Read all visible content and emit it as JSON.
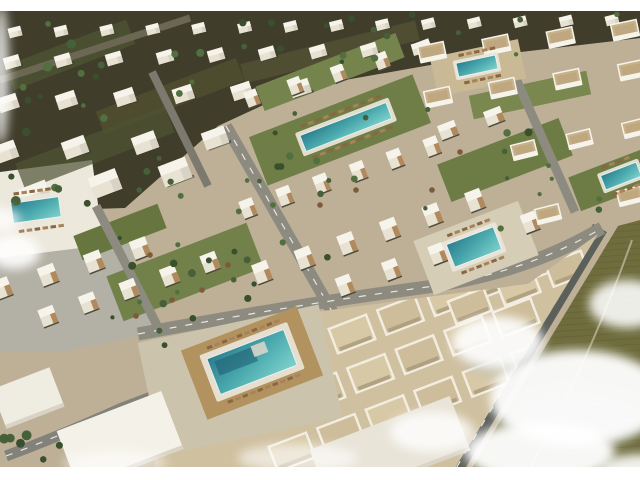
{
  "image_alt": "Aerial 3D architectural rendering of a coastal resort residential development with white cubic villas, tan-accented townhouses, apartment blocks, six turquoise swimming pools with sun loungers, palm trees, gray streets, an olive desert field at lower right and drifting white clouds",
  "letterbox": {
    "top_height": 11,
    "bottom_height": 13,
    "color": "#ffffff"
  },
  "palette": {
    "base": "#bdb097",
    "villa_ground": "#403d2b",
    "road_dash": "#e8e6df",
    "cloud": "#ffffff",
    "cloud_shadow": "#a3b2bb",
    "white_roof": "#f6f3ea",
    "white_wall": "#e8e2d2",
    "wall_shade": "#d8d3c5",
    "wood_tan": "#b08a5e",
    "apt_roof": "#c8b28b",
    "shadow_dark": "#4e4a3a"
  },
  "scene": {
    "base_fill": "#bdb097",
    "polygons": [
      {
        "name": "villa-district-ground",
        "fill": "#403d2b",
        "points": "0,10 640,10 640,38 470,58 300,88 218,126 125,208 0,212"
      },
      {
        "name": "left-pool-deck",
        "fill": "#ece8dc",
        "points": "0,172 92,160 104,248 0,262"
      },
      {
        "name": "parking-plaza",
        "fill": "#b3b0a5",
        "points": "0,258 128,242 158,332 60,352 0,352"
      }
    ],
    "ground_patches": [
      {
        "cx": 70,
        "cy": 55,
        "w": 130,
        "h": 26,
        "deg": -21,
        "fill": "#4e5433",
        "op": 0.8
      },
      {
        "cx": 170,
        "cy": 96,
        "w": 150,
        "h": 24,
        "deg": -21,
        "fill": "#51502f",
        "op": 0.8
      },
      {
        "cx": 95,
        "cy": 148,
        "w": 160,
        "h": 28,
        "deg": -21,
        "fill": "#4e5433",
        "op": 0.7
      },
      {
        "cx": 330,
        "cy": 52,
        "w": 180,
        "h": 20,
        "deg": -14,
        "fill": "#565538",
        "op": 0.7
      }
    ],
    "green_strips": [
      {
        "cx": 340,
        "cy": 130,
        "w": 175,
        "h": 52,
        "deg": -21,
        "fill": "#6f7d47"
      },
      {
        "cx": 330,
        "cy": 72,
        "w": 150,
        "h": 26,
        "deg": -21,
        "fill": "#75834d"
      },
      {
        "cx": 505,
        "cy": 160,
        "w": 130,
        "h": 40,
        "deg": -21,
        "fill": "#6d7b45"
      },
      {
        "cx": 185,
        "cy": 272,
        "w": 150,
        "h": 48,
        "deg": -21,
        "fill": "#72814a"
      },
      {
        "cx": 120,
        "cy": 232,
        "w": 90,
        "h": 26,
        "deg": -21,
        "fill": "#67763f"
      },
      {
        "cx": 612,
        "cy": 180,
        "w": 80,
        "h": 36,
        "deg": -21,
        "fill": "#6d7b45"
      },
      {
        "cx": 530,
        "cy": 95,
        "w": 120,
        "h": 24,
        "deg": -12,
        "fill": "#7a8850"
      }
    ],
    "roads": [
      {
        "name": "street-central",
        "x1": 226,
        "y1": 126,
        "x2": 338,
        "y2": 322,
        "w": 12,
        "color": "#8d8b80",
        "dash": true
      },
      {
        "name": "street-left",
        "x1": 96,
        "y1": 206,
        "x2": 162,
        "y2": 335,
        "w": 9,
        "color": "#8d8b80",
        "dash": false
      },
      {
        "name": "street-right",
        "x1": 498,
        "y1": 38,
        "x2": 575,
        "y2": 212,
        "w": 9,
        "color": "#8d8b80",
        "dash": false
      },
      {
        "name": "street-villa-district",
        "x1": 152,
        "y1": 72,
        "x2": 208,
        "y2": 186,
        "w": 8,
        "color": "#7c7a6e",
        "dash": false
      },
      {
        "name": "avenue-top-left",
        "x1": 0,
        "y1": 80,
        "x2": 190,
        "y2": 18,
        "w": 7,
        "color": "#6b6753",
        "dash": false
      },
      {
        "name": "road-perimeter-east",
        "x1": 600,
        "y1": 228,
        "x2": 455,
        "y2": 470,
        "w": 16,
        "color": "#5c605a",
        "dash": true
      }
    ],
    "road_paths": [
      {
        "name": "avenue-main",
        "d": "M 138,334 Q 300,304 420,288 Q 525,274 602,228",
        "w": 13,
        "color": "#8d8b80",
        "dash": true
      },
      {
        "name": "road-curve-southwest",
        "d": "M 6,456 Q 60,436 122,408 Q 165,392 215,372 Q 248,358 272,342",
        "w": 11,
        "color": "#83827a",
        "dash": true
      }
    ],
    "field": {
      "name": "desert-field",
      "fill": "#6f6d3e",
      "points": "618,226 640,220 640,468 472,468",
      "line_color": "#625f33",
      "path": "M 632,240 Q 600,330 565,400 Q 548,435 530,468",
      "path_color": "#b7b294"
    },
    "superblock": {
      "name": "apartment-superblock",
      "fill": "#cfc0a0",
      "points": "150,340 300,314 420,298 528,284 598,234 455,468 155,468",
      "step": 52,
      "deg": -21,
      "roof_rows": [
        {
          "x": 352,
          "y": 334,
          "n": 5,
          "w": 40,
          "h": 26
        },
        {
          "x": 322,
          "y": 392,
          "n": 5,
          "w": 40,
          "h": 26
        },
        {
          "x": 292,
          "y": 452,
          "n": 6,
          "w": 40,
          "h": 26
        },
        {
          "x": 470,
          "y": 306,
          "n": 3,
          "w": 38,
          "h": 24
        }
      ],
      "roof_fills": [
        "#d8c9a6",
        "#cdbd9a"
      ],
      "parapet": "#f2ede0",
      "shadow": "#a89878"
    },
    "plazas": [
      {
        "name": "pool-plaza-main",
        "cx": 240,
        "cy": 380,
        "w": 185,
        "h": 115,
        "deg": -12,
        "fill": "#ccc3ad"
      },
      {
        "name": "pool-deck-wood",
        "cx": 252,
        "cy": 363,
        "w": 124,
        "h": 74,
        "deg": -21,
        "fill": "#b2925f"
      },
      {
        "name": "pool-plaza-right",
        "cx": 476,
        "cy": 248,
        "w": 112,
        "h": 58,
        "deg": -21,
        "fill": "#d6cdb6"
      },
      {
        "name": "courtyard-top-right",
        "cx": 478,
        "cy": 68,
        "w": 90,
        "h": 40,
        "deg": -12,
        "fill": "#c9b995"
      }
    ],
    "white_buildings": [
      {
        "name": "white-building-southwest",
        "cx": 120,
        "cy": 440,
        "w": 112,
        "h": 62,
        "deg": -21,
        "fill": "#f4f1e8"
      },
      {
        "name": "white-building-west",
        "cx": 28,
        "cy": 398,
        "w": 62,
        "h": 42,
        "deg": -21,
        "fill": "#efece2"
      },
      {
        "name": "white-roofs-south",
        "cx": 390,
        "cy": 450,
        "w": 150,
        "h": 58,
        "deg": -21,
        "fill": "#e9e4d8"
      }
    ],
    "building_rows": [
      {
        "t": "villa",
        "x0": 15,
        "y0": 32,
        "x1": 612,
        "y1": 20,
        "n": 14,
        "w": 13,
        "h": 10,
        "deg": -14
      },
      {
        "t": "villa",
        "x0": 12,
        "y0": 62,
        "x1": 420,
        "y1": 48,
        "n": 9,
        "w": 16,
        "h": 12,
        "deg": -16
      },
      {
        "t": "villa",
        "x0": 8,
        "y0": 103,
        "x1": 300,
        "y1": 88,
        "n": 6,
        "w": 20,
        "h": 15,
        "deg": -18
      },
      {
        "t": "villa",
        "x0": 5,
        "y0": 152,
        "x1": 215,
        "y1": 138,
        "n": 4,
        "w": 24,
        "h": 18,
        "deg": -20
      },
      {
        "t": "villa",
        "x0": 35,
        "y0": 195,
        "x1": 175,
        "y1": 172,
        "n": 3,
        "w": 29,
        "h": 22,
        "deg": -21
      },
      {
        "t": "town",
        "x0": 252,
        "y0": 98,
        "x1": 425,
        "y1": 48,
        "n": 5,
        "w": 13,
        "h": 16,
        "deg": -21
      },
      {
        "t": "town",
        "x0": 248,
        "y0": 208,
        "x1": 432,
        "y1": 146,
        "n": 6,
        "w": 14,
        "h": 18,
        "deg": -21
      },
      {
        "t": "town",
        "x0": 262,
        "y0": 272,
        "x1": 475,
        "y1": 200,
        "n": 6,
        "w": 16,
        "h": 20,
        "deg": -21
      },
      {
        "t": "town",
        "x0": 345,
        "y0": 285,
        "x1": 530,
        "y1": 222,
        "n": 5,
        "w": 15,
        "h": 19,
        "deg": -21
      },
      {
        "t": "town",
        "x0": 48,
        "y0": 316,
        "x1": 210,
        "y1": 262,
        "n": 5,
        "w": 16,
        "h": 18,
        "deg": -21
      },
      {
        "t": "town",
        "x0": 2,
        "y0": 288,
        "x1": 140,
        "y1": 248,
        "n": 4,
        "w": 17,
        "h": 19,
        "deg": -21
      },
      {
        "t": "town",
        "x0": 448,
        "y0": 130,
        "x1": 494,
        "y1": 116,
        "n": 2,
        "w": 18,
        "h": 15,
        "deg": -21
      },
      {
        "t": "apt",
        "x0": 432,
        "y0": 52,
        "x1": 625,
        "y1": 30,
        "n": 4,
        "w": 26,
        "h": 16,
        "deg": -12
      },
      {
        "t": "apt",
        "x0": 438,
        "y0": 97,
        "x1": 632,
        "y1": 70,
        "n": 4,
        "w": 26,
        "h": 16,
        "deg": -12
      },
      {
        "t": "apt",
        "x0": 524,
        "y0": 150,
        "x1": 635,
        "y1": 128,
        "n": 3,
        "w": 24,
        "h": 15,
        "deg": -14
      },
      {
        "t": "apt",
        "x0": 548,
        "y0": 214,
        "x1": 630,
        "y1": 196,
        "n": 2,
        "w": 24,
        "h": 15,
        "deg": -14
      }
    ],
    "pool_colors": {
      "deep": "#2b7d8e",
      "mid": "#4aa9ad",
      "light": "#7fd2cd",
      "deck": "#eae6da",
      "edge": "#f0f4f2",
      "inner_dark": "#1f6074",
      "step_white": "#d8d4c8"
    },
    "lounger_colors": [
      "#8a6642",
      "#a8835a"
    ],
    "pools": [
      {
        "name": "pool-central-linear",
        "cx": 346,
        "cy": 127,
        "w": 92,
        "h": 17,
        "deg": -21,
        "pad": 4
      },
      {
        "name": "pool-courtyard-topright",
        "cx": 477,
        "cy": 66,
        "w": 40,
        "h": 14,
        "deg": -12,
        "pad": 3
      },
      {
        "name": "pool-west",
        "cx": 36,
        "cy": 210,
        "w": 48,
        "h": 20,
        "deg": -8,
        "pad": 5
      },
      {
        "name": "pool-right-plaza",
        "cx": 474,
        "cy": 247,
        "w": 50,
        "h": 24,
        "deg": -21,
        "pad": 4
      },
      {
        "name": "pool-east-edge",
        "cx": 621,
        "cy": 176,
        "w": 38,
        "h": 15,
        "deg": -21,
        "pad": 3
      },
      {
        "name": "pool-main-south",
        "cx": 252,
        "cy": 362,
        "w": 82,
        "h": 38,
        "deg": -21,
        "pad": 6,
        "main": true
      }
    ],
    "tree_colors": [
      "#3a4f2e",
      "#46603a",
      "#52703f"
    ],
    "tree_zones": [
      {
        "x": 0,
        "y": 14,
        "w": 230,
        "h": 190,
        "n": 26,
        "seed": 7,
        "rmin": 2,
        "rmax": 5
      },
      {
        "x": 230,
        "y": 12,
        "w": 400,
        "h": 50,
        "n": 16,
        "seed": 11,
        "rmin": 2,
        "rmax": 4
      },
      {
        "x": 240,
        "y": 90,
        "w": 210,
        "h": 120,
        "n": 12,
        "seed": 3,
        "rmin": 2,
        "rmax": 4
      },
      {
        "x": 105,
        "y": 220,
        "w": 145,
        "h": 112,
        "n": 12,
        "seed": 5,
        "rmin": 2,
        "rmax": 4
      },
      {
        "x": 495,
        "y": 120,
        "w": 140,
        "h": 130,
        "n": 10,
        "seed": 9,
        "rmin": 2,
        "rmax": 4
      },
      {
        "x": 235,
        "y": 150,
        "w": 100,
        "h": 170,
        "n": 8,
        "seed": 21,
        "rmin": 2,
        "rmax": 4
      },
      {
        "x": 0,
        "y": 425,
        "w": 85,
        "h": 40,
        "n": 6,
        "seed": 13,
        "rmin": 3,
        "rmax": 5
      },
      {
        "x": 150,
        "y": 300,
        "w": 60,
        "h": 55,
        "n": 4,
        "seed": 17,
        "rmin": 2,
        "rmax": 4
      }
    ],
    "umbrella_color": "#7d5a38",
    "umbrellas": [
      [
        150,
        255
      ],
      [
        172,
        300
      ],
      [
        202,
        290
      ],
      [
        136,
        316
      ],
      [
        228,
        265
      ],
      [
        320,
        205
      ],
      [
        356,
        190
      ],
      [
        460,
        152
      ],
      [
        432,
        190
      ]
    ],
    "cloud_shadows": [
      {
        "cx": 575,
        "cy": 415,
        "rx": 75,
        "ry": 32,
        "op": 0.45
      },
      {
        "cx": 505,
        "cy": 360,
        "rx": 40,
        "ry": 18,
        "op": 0.35
      }
    ],
    "clouds": [
      {
        "cx": 578,
        "cy": 398,
        "rx": 88,
        "ry": 48,
        "op": 0.95
      },
      {
        "cx": 498,
        "cy": 342,
        "rx": 46,
        "ry": 26,
        "op": 0.9
      },
      {
        "cx": 627,
        "cy": 304,
        "rx": 38,
        "ry": 24,
        "op": 0.88
      },
      {
        "cx": 540,
        "cy": 452,
        "rx": 75,
        "ry": 30,
        "op": 0.95
      },
      {
        "cx": 432,
        "cy": 432,
        "rx": 42,
        "ry": 20,
        "op": 0.8
      },
      {
        "cx": 298,
        "cy": 458,
        "rx": 60,
        "ry": 14,
        "op": 0.6
      },
      {
        "cx": 115,
        "cy": 463,
        "rx": 52,
        "ry": 12,
        "op": 0.5
      },
      {
        "cx": 14,
        "cy": 252,
        "rx": 26,
        "ry": 17,
        "op": 0.9
      },
      {
        "cx": 2,
        "cy": 220,
        "rx": 18,
        "ry": 12,
        "op": 0.75
      },
      {
        "cx": 640,
        "cy": 470,
        "rx": 40,
        "ry": 16,
        "op": 0.9
      },
      {
        "cx": 1,
        "cy": 75,
        "rx": 8,
        "ry": 70,
        "op": 0.8
      }
    ]
  }
}
